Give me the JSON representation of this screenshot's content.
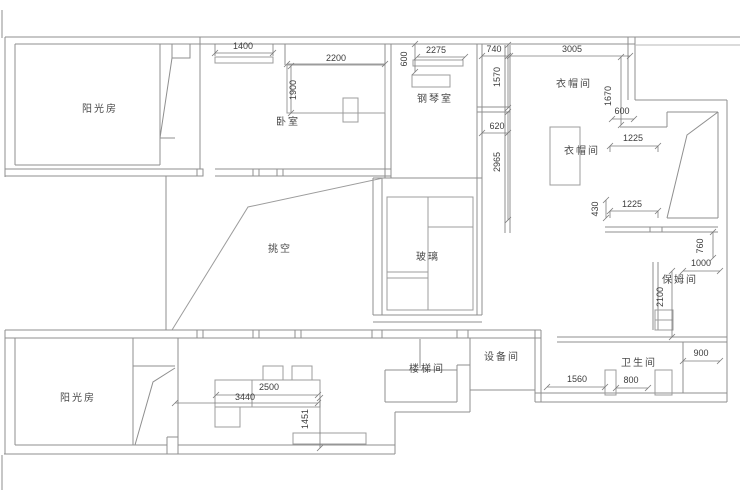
{
  "document": {
    "type": "residential-floor-plan",
    "language": "zh-CN"
  },
  "colors": {
    "background": "#ffffff",
    "wall": "#8f8f8f",
    "wall_light": "#b7b7b7",
    "furniture": "#9c9c9c",
    "dimension_line": "#7d7d7d",
    "dimension_text": "#3c3c3c",
    "room_label_text": "#4a4a4a"
  },
  "rooms": [
    {
      "id": "sunroom-top",
      "label": "阳光房"
    },
    {
      "id": "bedroom",
      "label": "卧室"
    },
    {
      "id": "piano-room",
      "label": "钢琴室"
    },
    {
      "id": "cloakroom-1",
      "label": "衣帽间"
    },
    {
      "id": "cloakroom-2",
      "label": "衣帽间"
    },
    {
      "id": "void-double-height",
      "label": "挑空"
    },
    {
      "id": "glass",
      "label": "玻璃"
    },
    {
      "id": "nanny-room",
      "label": "保姆间"
    },
    {
      "id": "stairwell",
      "label": "楼梯间"
    },
    {
      "id": "equipment-room",
      "label": "设备间"
    },
    {
      "id": "bathroom",
      "label": "卫生间"
    },
    {
      "id": "sunroom-bottom",
      "label": "阳光房"
    }
  ],
  "dimensions": [
    {
      "id": "dim-1400",
      "value": "1400"
    },
    {
      "id": "dim-2200",
      "value": "2200"
    },
    {
      "id": "dim-1900",
      "value": "1900"
    },
    {
      "id": "dim-600-piano",
      "value": "600"
    },
    {
      "id": "dim-2275",
      "value": "2275"
    },
    {
      "id": "dim-740",
      "value": "740"
    },
    {
      "id": "dim-3005",
      "value": "3005"
    },
    {
      "id": "dim-1570",
      "value": "1570"
    },
    {
      "id": "dim-620",
      "value": "620"
    },
    {
      "id": "dim-2965",
      "value": "2965"
    },
    {
      "id": "dim-1670",
      "value": "1670"
    },
    {
      "id": "dim-600-closet",
      "value": "600"
    },
    {
      "id": "dim-1225-a",
      "value": "1225"
    },
    {
      "id": "dim-430",
      "value": "430"
    },
    {
      "id": "dim-1225-b",
      "value": "1225"
    },
    {
      "id": "dim-760",
      "value": "760"
    },
    {
      "id": "dim-1000",
      "value": "1000"
    },
    {
      "id": "dim-2100",
      "value": "2100"
    },
    {
      "id": "dim-900",
      "value": "900"
    },
    {
      "id": "dim-1560",
      "value": "1560"
    },
    {
      "id": "dim-800",
      "value": "800"
    },
    {
      "id": "dim-2500",
      "value": "2500"
    },
    {
      "id": "dim-3440",
      "value": "3440"
    },
    {
      "id": "dim-1451",
      "value": "1451"
    }
  ]
}
